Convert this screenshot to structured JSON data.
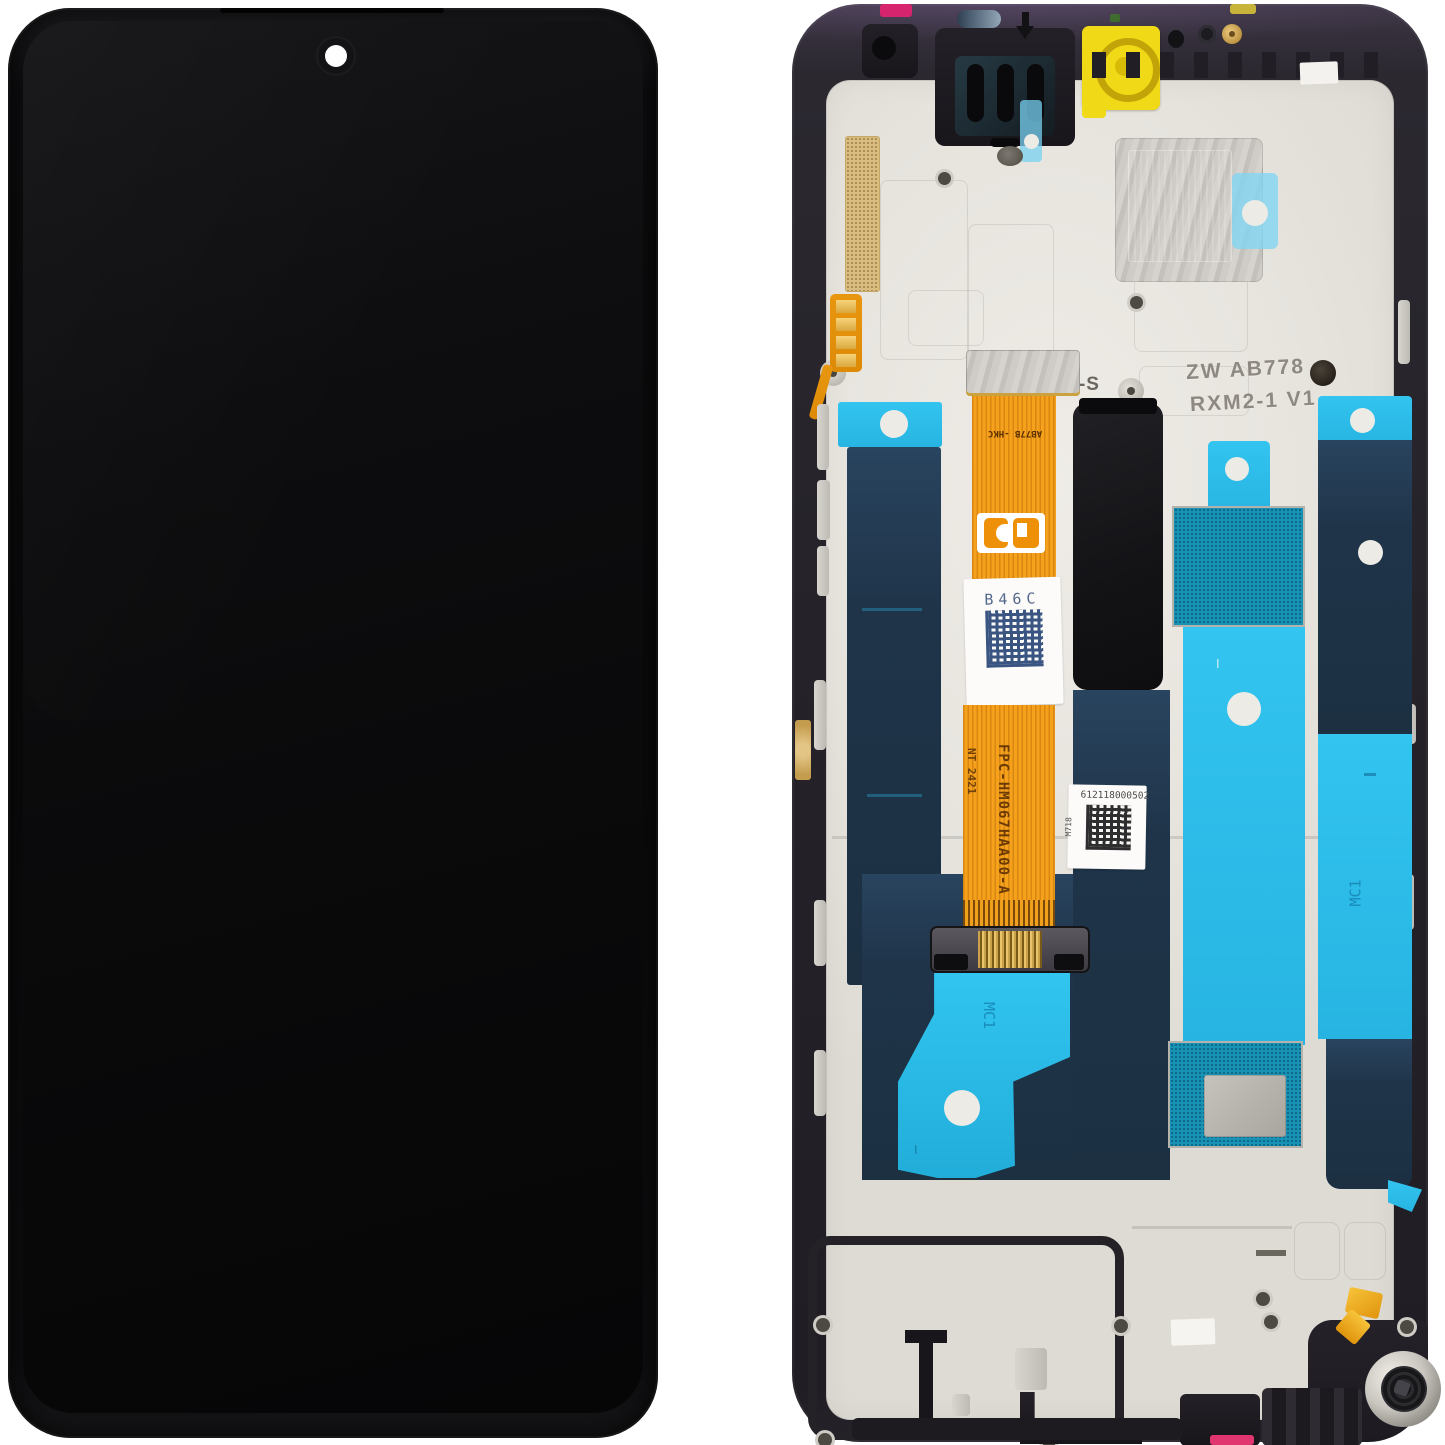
{
  "markings": {
    "flex_part_number": "FPC-HM067HAA00-A",
    "flex_date_code": "NT 2421",
    "flex_batch_code": "B46C",
    "flex_top_code": "AB77B -HKC",
    "etched_line1": "ZW AB778",
    "etched_line2": "RXM2-1 V1",
    "etched_line3": "07.1-S",
    "serial_number": "612118000502",
    "serial_side_code": "M718",
    "center_flex_code": "MC1",
    "right_adhesive_code": "MC1",
    "adhesive_tick": "I"
  },
  "colors": {
    "bg": "#ffffff",
    "frame": "#26232a",
    "metal": "#e7e4df",
    "cyan": "#2bbde9",
    "teal-mesh": "#1793b6",
    "navy": "#1f3850",
    "orange": "#f5a11b",
    "orange-deep": "#dd8a07",
    "yellow": "#f0d916",
    "yellow-ring": "#c2a408",
    "magenta": "#d6246e",
    "pink": "#e0356e",
    "gold": "#d9bc80",
    "label-white": "#fcfbfa"
  }
}
